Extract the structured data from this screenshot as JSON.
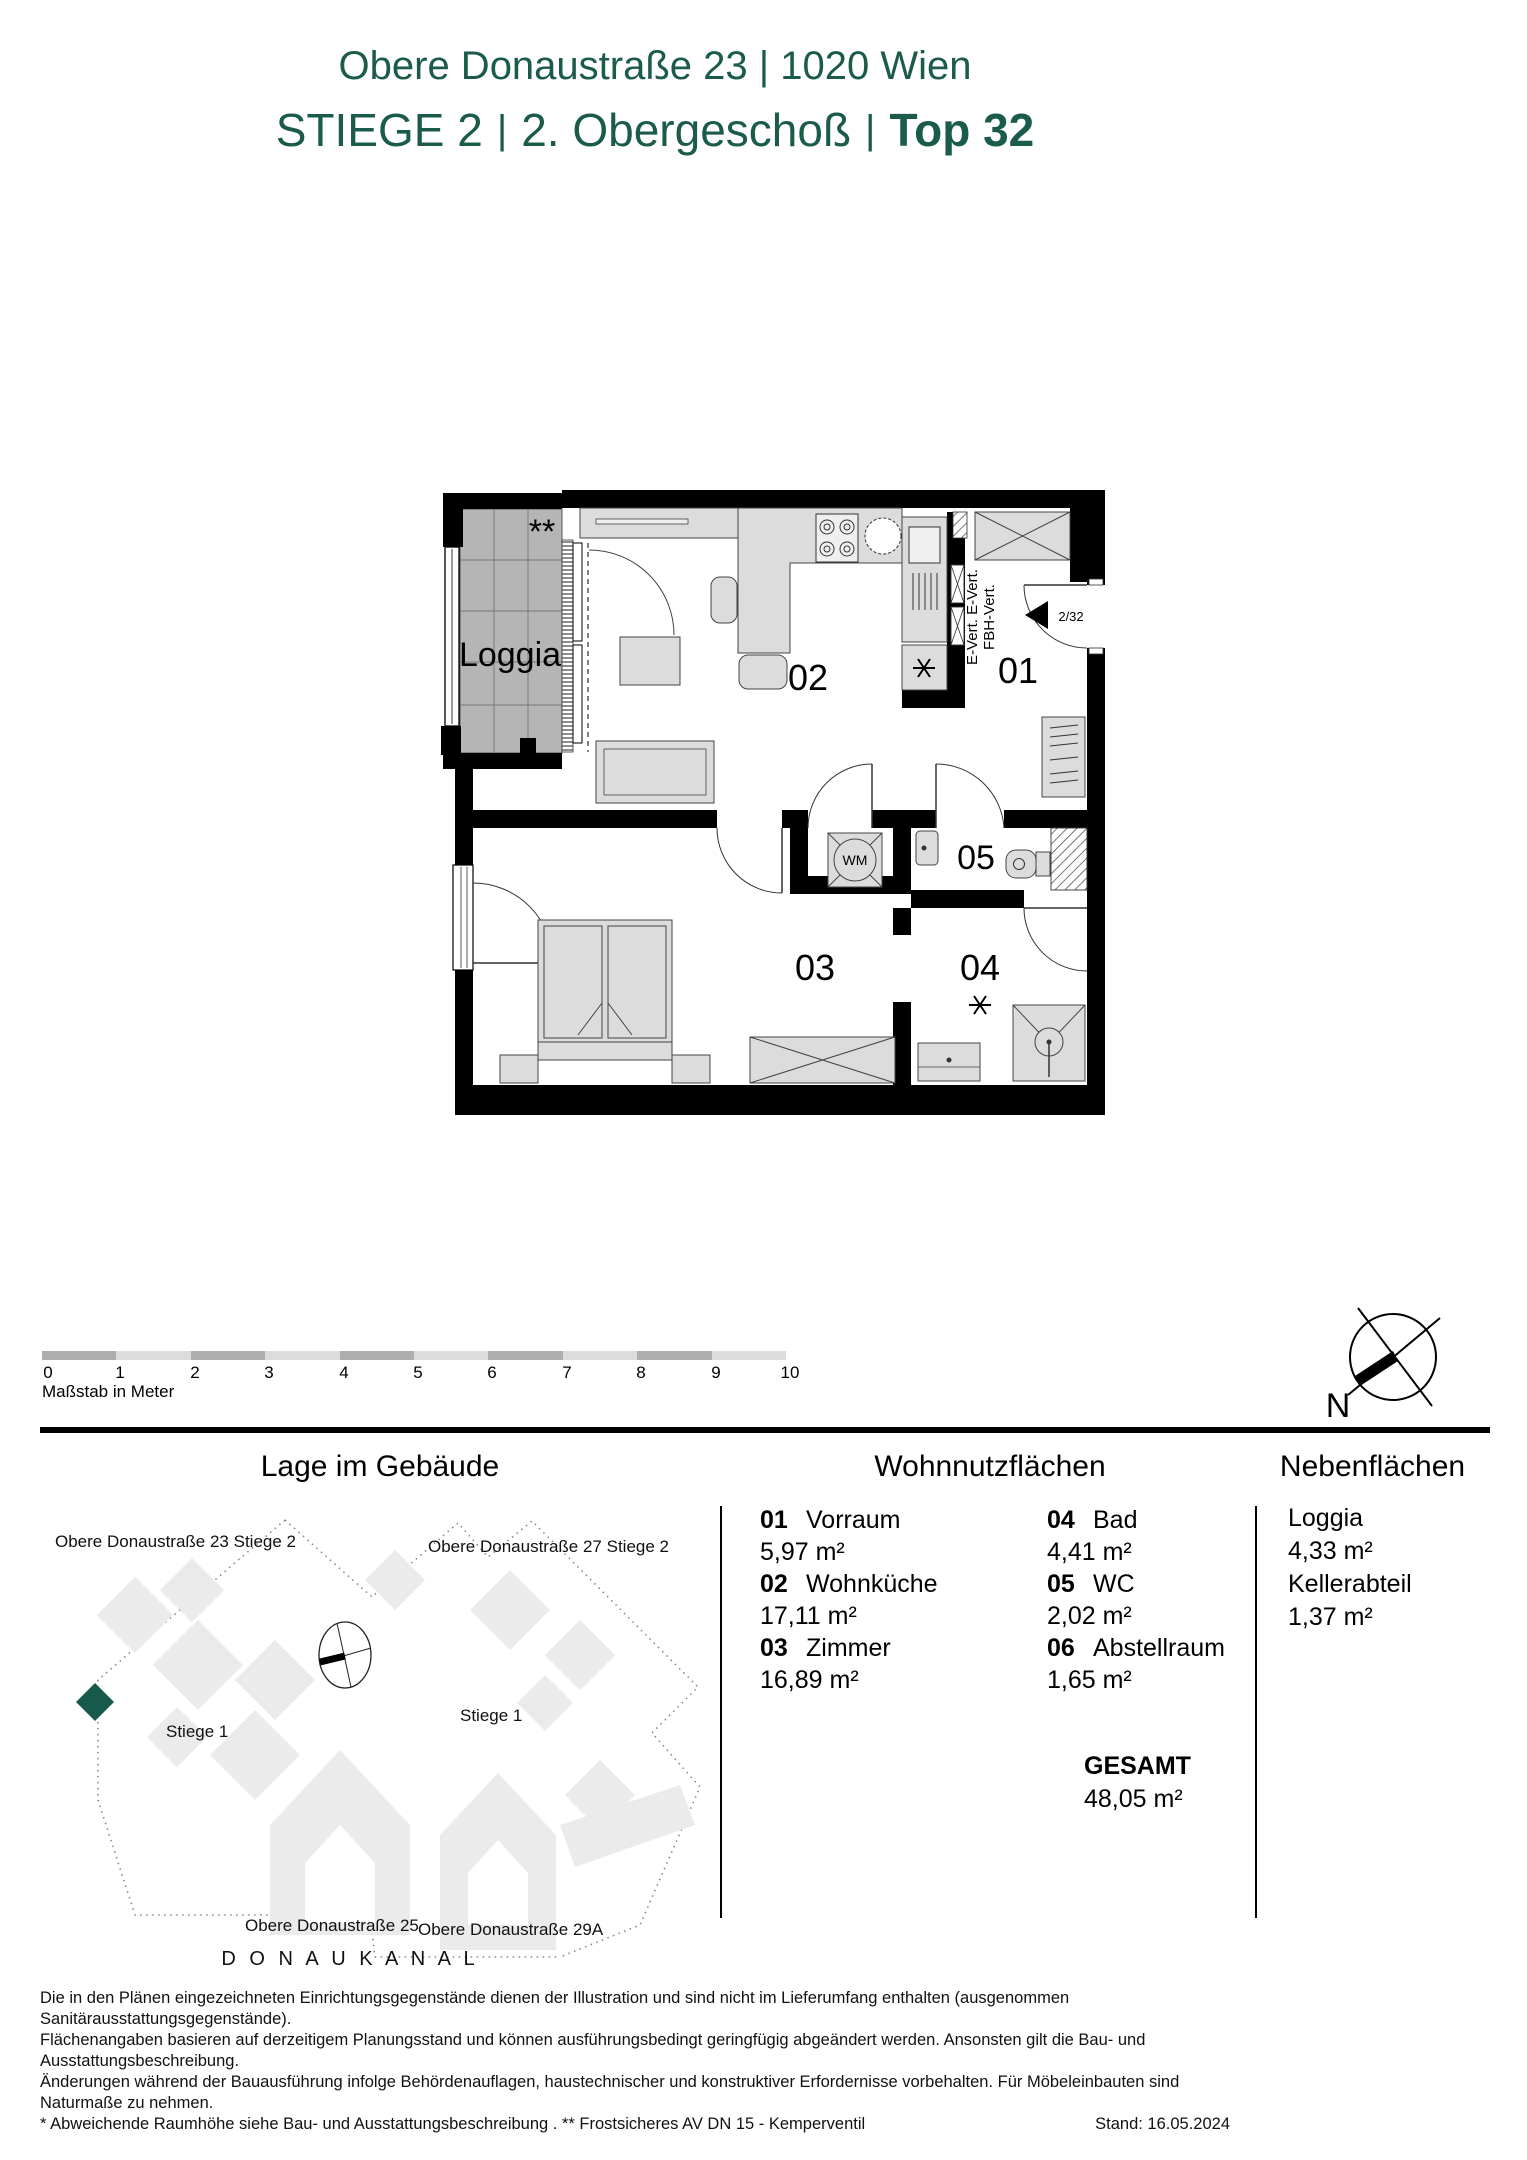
{
  "header": {
    "address": "Obere Donaustraße 23 | 1020 Wien",
    "subtitle_stiege": "STIEGE 2",
    "subtitle_sep1": "|",
    "subtitle_floor": "2. Obergeschoß",
    "subtitle_sep2": "|",
    "subtitle_top": "Top 32",
    "accent_color": "#1b5b4b"
  },
  "plan": {
    "loggia_label": "Loggia",
    "loggia_note": "**",
    "room_01": "01",
    "room_02": "02",
    "room_03": "03",
    "room_04": "04",
    "room_05": "05",
    "door_tag": "2/32",
    "shaft_line1": "E-Vert. E-Vert.",
    "shaft_line2": "FBH-Vert.",
    "wm_label": "WM"
  },
  "scale_bar": {
    "ticks": [
      "0",
      "1",
      "2",
      "3",
      "4",
      "5",
      "6",
      "7",
      "8",
      "9",
      "10"
    ],
    "caption": "Maßstab in Meter"
  },
  "compass": {
    "north_label": "N"
  },
  "site": {
    "title": "Lage im Gebäude",
    "label_building_23": "Obere Donaustraße 23 Stiege 2",
    "label_building_27": "Obere Donaustraße 27 Stiege 2",
    "label_stiege1_right": "Stiege 1",
    "label_stiege1_left": "Stiege 1",
    "label_building_25": "Obere Donaustraße 25",
    "label_building_29a": "Obere Donaustraße 29A",
    "label_canal": "D O N A U K A N A L",
    "marker_color": "#17594a"
  },
  "areas": {
    "main_title": "Wohnnutzflächen",
    "rooms": [
      {
        "no": "01",
        "name": "Vorraum",
        "area": "5,97 m²"
      },
      {
        "no": "02",
        "name": "Wohnküche",
        "area": "17,11 m²"
      },
      {
        "no": "03",
        "name": "Zimmer",
        "area": "16,89 m²"
      },
      {
        "no": "04",
        "name": "Bad",
        "area": "4,41 m²"
      },
      {
        "no": "05",
        "name": "WC",
        "area": "2,02 m²"
      },
      {
        "no": "06",
        "name": "Abstellraum",
        "area": "1,65 m²"
      }
    ],
    "total_label": "GESAMT",
    "total_value": "48,05 m²",
    "side_title": "Nebenflächen",
    "side_items": [
      {
        "name": "Loggia",
        "area": "4,33 m²"
      },
      {
        "name": "Kellerabteil",
        "area": "1,37 m²"
      }
    ]
  },
  "footer": {
    "line1": "Die in den Plänen eingezeichneten Einrichtungsgegenstände dienen der Illustration und sind nicht im Lieferumfang enthalten (ausgenommen Sanitärausstattungsgegenstände).",
    "line2": "Flächenangaben basieren auf derzeitigem Planungsstand und können ausführungsbedingt geringfügig abgeändert werden. Ansonsten gilt die Bau- und Ausstattungsbeschreibung.",
    "line3": "Änderungen während der Bauausführung infolge Behördenauflagen, haustechnischer und konstruktiver Erfordernisse vorbehalten. Für Möbeleinbauten sind Naturmaße zu nehmen.",
    "line4": "* Abweichende Raumhöhe siehe Bau- und Ausstattungsbeschreibung . ** Frostsicheres AV DN 15 - Kemperventil",
    "stand": "Stand: 16.05.2024"
  }
}
